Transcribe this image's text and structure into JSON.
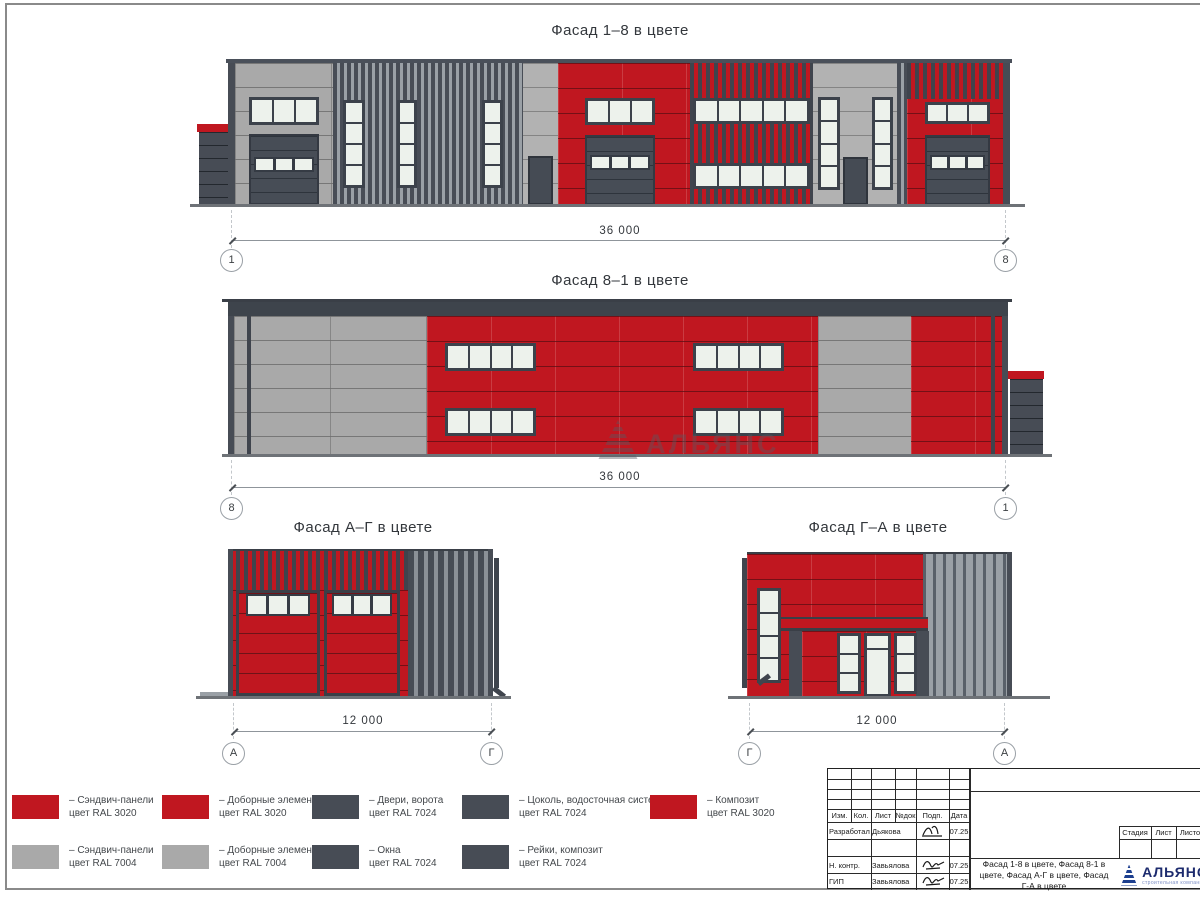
{
  "watermark": {
    "text": "АЛЬЯНС"
  },
  "facades": {
    "f18": {
      "title": "Фасад 1–8 в цвете",
      "dim": "36 000",
      "ax_l": "1",
      "ax_r": "8"
    },
    "f81": {
      "title": "Фасад 8–1 в цвете",
      "dim": "36 000",
      "ax_l": "8",
      "ax_r": "1"
    },
    "fag": {
      "title": "Фасад А–Г в цвете",
      "dim": "12 000",
      "ax_l": "А",
      "ax_r": "Г"
    },
    "fga": {
      "title": "Фасад Г–А в цвете",
      "dim": "12 000",
      "ax_l": "Г",
      "ax_r": "А"
    }
  },
  "colors": {
    "red": "#c01720",
    "gray": "#a9a9a9",
    "dark": "#474c55"
  },
  "legend": {
    "items": [
      {
        "label": "– Сэндвич-панели",
        "ral": "цвет RAL 3020",
        "color": "#c01720"
      },
      {
        "label": "– Доборные элементы",
        "ral": "цвет RAL 3020",
        "color": "#c01720"
      },
      {
        "label": "– Двери, ворота",
        "ral": "цвет RAL 7024",
        "color": "#474c55"
      },
      {
        "label": "– Цоколь, водосточная система",
        "ral": "цвет RAL 7024",
        "color": "#474c55"
      },
      {
        "label": "– Композит",
        "ral": "цвет RAL 3020",
        "color": "#c01720"
      },
      {
        "label": "– Сэндвич-панели",
        "ral": "цвет RAL 7004",
        "color": "#a9a9a9"
      },
      {
        "label": "– Доборные элементы",
        "ral": "цвет RAL 7004",
        "color": "#a9a9a9"
      },
      {
        "label": "– Окна",
        "ral": "цвет RAL 7024",
        "color": "#474c55"
      },
      {
        "label": "– Рейки, композит",
        "ral": "цвет RAL 7024",
        "color": "#474c55"
      }
    ]
  },
  "tb": {
    "headers": [
      "Изм.",
      "Кол.",
      "Лист",
      "№док",
      "Подп.",
      "Дата"
    ],
    "rows": [
      {
        "role": "Разработал",
        "name": "Дьякова",
        "date": "07.25"
      },
      {
        "role": "Н. контр.",
        "name": "Завьялова",
        "date": "07.25"
      },
      {
        "role": "ГИП",
        "name": "Завьялова",
        "date": "07.25"
      }
    ],
    "stage": [
      "Стадия",
      "Лист",
      "Листов"
    ],
    "title": "Фасад 1-8 в цвете, Фасад 8-1 в цвете, Фасад А-Г в цвете, Фасад Г-А в цвете",
    "logo": "АЛЬЯНС",
    "logo_sub": "строительная компания"
  }
}
